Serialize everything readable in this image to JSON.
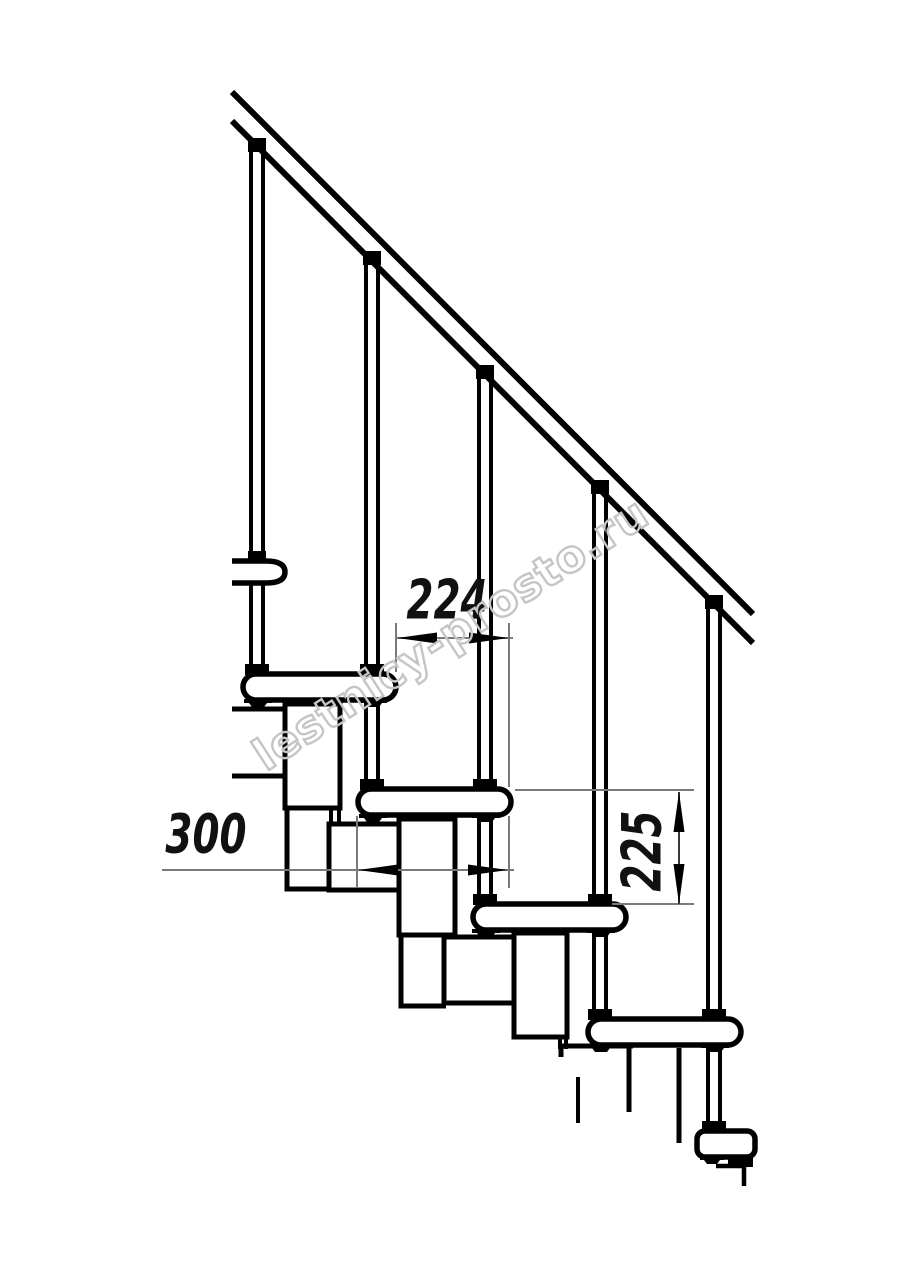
{
  "meta": {
    "description": "Technical side-elevation drawing of a modular staircase with handrail",
    "background": "#ffffff",
    "line_color": "#000000",
    "dim_line_color": "#7a7a7a",
    "dim_text_color": "#111111"
  },
  "dimensions": {
    "step_run": {
      "value": "224",
      "orientation": "horizontal"
    },
    "tread_depth": {
      "value": "300",
      "orientation": "horizontal"
    },
    "step_rise": {
      "value": "225",
      "orientation": "vertical"
    }
  },
  "structure": {
    "handrail": "handrail",
    "balusters_count": 5,
    "treads_count": 6
  },
  "watermark": {
    "text": "lestnicy-prosto.ru",
    "color": "#c5c5c5"
  }
}
